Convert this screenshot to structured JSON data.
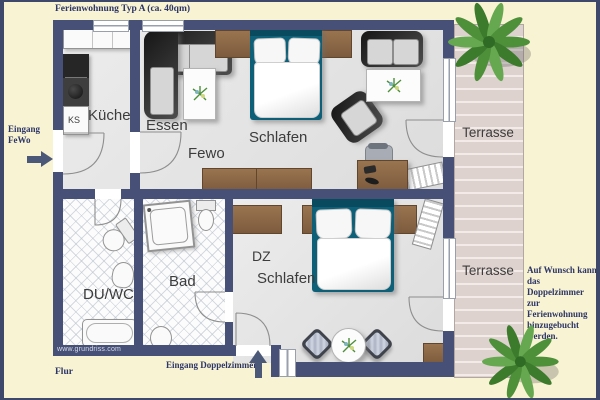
{
  "title": "Ferienwohnung Typ A (ca. 40qm)",
  "rooms": {
    "kueche": "Küche",
    "essen": "Essen",
    "fewo": "Fewo",
    "schlafen_fewo": "Schlafen",
    "terrasse_top": "Terrasse",
    "du_wc": "DU/WC",
    "bad": "Bad",
    "dz": "DZ",
    "schlafen_dz": "Schlafen",
    "terrasse_bottom": "Terrasse",
    "ks": "KS"
  },
  "labels": {
    "eingang_fewo": "Eingang\nFeWo",
    "eingang_doppelzimmer": "Eingang Doppelzimmer",
    "flur": "Flur",
    "note": "Auf Wunsch kann\ndas Doppelzimmer\nzur Ferienwohnung\nhinzugebucht\nwerden.",
    "watermark": "www.grundriss.com"
  },
  "colors": {
    "background": "#f8f3d2",
    "wall": "#475077",
    "floor": "#e4e4e4",
    "wood": "#8f6b49",
    "bed_frame": "#0e6078",
    "terrace_plank": "#ddd2ce",
    "annotation_text": "#2c3567",
    "plant_green": "#4e8f3a"
  }
}
